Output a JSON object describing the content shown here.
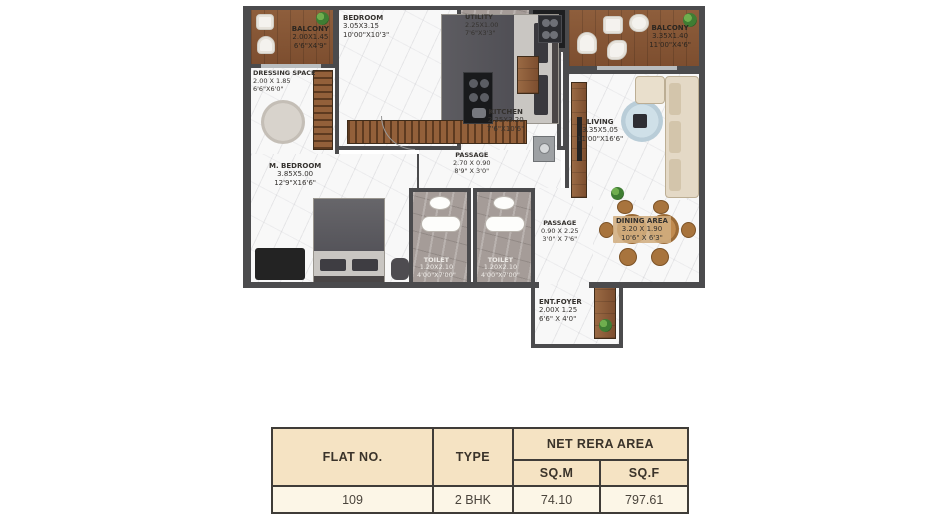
{
  "plan": {
    "rooms": [
      {
        "name": "BALCONY",
        "m": "2.00X1.45",
        "ft": "6'6\"X4'9\""
      },
      {
        "name": "BEDROOM",
        "m": "3.05X3.15",
        "ft": "10'00\"X10'3\""
      },
      {
        "name": "UTILITY",
        "m": "2.25X1.00",
        "ft": "7'6\"X3'3\""
      },
      {
        "name": "BALCONY",
        "m": "3.35X1.40",
        "ft": "11'00\"X4'6\""
      },
      {
        "name": "DRESSING SPACE",
        "m": "2.00 X 1.85",
        "ft": "6'6\"X6'0\""
      },
      {
        "name": "KITCHEN",
        "m": "2.25X3.20",
        "ft": "7'6\"X10'6\""
      },
      {
        "name": "LIVING",
        "m": "3.35X5.05",
        "ft": "11'00\"X16'6\""
      },
      {
        "name": "M. BEDROOM",
        "m": "3.85X5.00",
        "ft": "12'9\"X16'6\""
      },
      {
        "name": "PASSAGE",
        "m": "2.70 X 0.90",
        "ft": "8'9\" X 3'0\""
      },
      {
        "name": "TOILET",
        "m": "1.20X2.10",
        "ft": "4'00\"X7'00\""
      },
      {
        "name": "TOILET",
        "m": "1.20X2.10",
        "ft": "4'00\"X7'00\""
      },
      {
        "name": "PASSAGE",
        "m": "0.90 X 2.25",
        "ft": "3'0\" X 7'6\""
      },
      {
        "name": "DINING AREA",
        "m": "3.20 X 1.90",
        "ft": "10'6\" X 6'3\""
      },
      {
        "name": "ENT.FOYER",
        "m": "2.00X 1.25",
        "ft": "6'6\" X 4'0\""
      }
    ],
    "colors": {
      "wall": "#4b4b4d",
      "wood": "#8a5a38",
      "marble": "#f8f8f8"
    }
  },
  "table": {
    "headers": {
      "flat_no": "FLAT NO.",
      "type": "TYPE",
      "net_rera": "NET RERA AREA",
      "sqm": "SQ.M",
      "sqf": "SQ.F"
    },
    "row": {
      "flat_no": "109",
      "type": "2 BHK",
      "sqm": "74.10",
      "sqf": "797.61"
    },
    "colors": {
      "header_bg": "#f5e3c3",
      "row_bg": "#fcf6e7",
      "border": "#3f3c38"
    }
  }
}
